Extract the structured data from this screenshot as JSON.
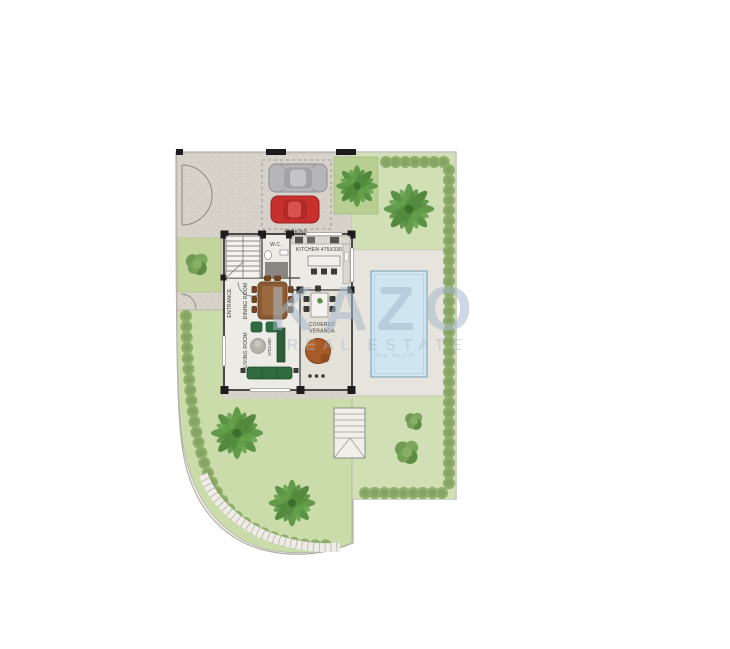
{
  "watermark": {
    "brand": "KAZO",
    "subtitle": "REAL ESTATE",
    "fineprint": "Reg. No.534"
  },
  "labels": {
    "parking": "PARKING",
    "wc": "W.C.",
    "kitchen": "KITCHEN 475X330",
    "entrance": "ENTRANCE",
    "dining_room": "DINING ROOM",
    "dining_dim": "385X600",
    "living_room": "LIVING ROOM",
    "living_dim": "670X480",
    "veranda_line1": "COVERED",
    "veranda_line2": "VERANDA"
  },
  "colors": {
    "paving": "#d7d3cb",
    "deck": "#e7e4dd",
    "floor": "#edebe5",
    "veranda_floor": "#e4e1d9",
    "garden_left": "#cbdcab",
    "garden_right": "#d0dfb4",
    "palm_square": "#b7cf92",
    "hedge": "#8fae6c",
    "palm": "#4f8a3c",
    "pool_water": "#cfe6f1",
    "pool_border": "#8fb0c0",
    "wall": "#3f3f3d",
    "sofa_green": "#2e6b3e",
    "table_brown": "#8a5a33",
    "veranda_table": "#a85a28",
    "car_red": "#c8302e",
    "car_silver": "#b6b6b8",
    "watermark": "#a6bacc"
  }
}
